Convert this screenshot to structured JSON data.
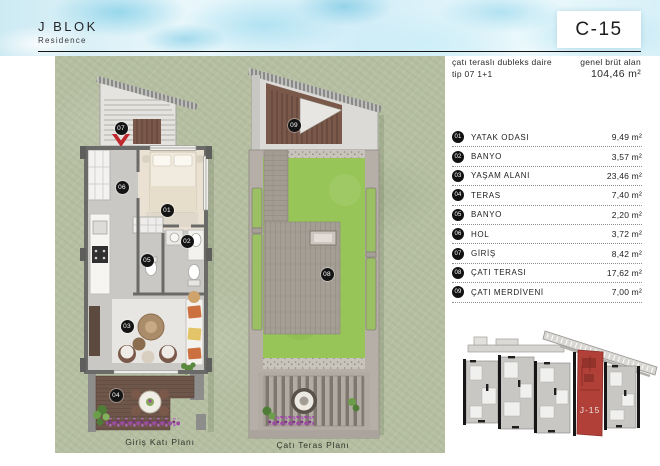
{
  "header": {
    "project": "J BLOK",
    "project_sub": "Residence",
    "unit_code": "C-15"
  },
  "unit_info": {
    "type_label": "çatı teraslı dubleks daire",
    "type_code": "tip 07 1+1",
    "area_label": "genel brüt alan",
    "area_value": "104,46 m²"
  },
  "plans": {
    "ground": {
      "caption": "Giriş Katı Planı"
    },
    "roof": {
      "caption": "Çatı Teras Planı"
    }
  },
  "rooms": [
    {
      "no": "01",
      "label": "YATAK ODASI",
      "area": "9,49 m²"
    },
    {
      "no": "02",
      "label": "BANYO",
      "area": "3,57 m²"
    },
    {
      "no": "03",
      "label": "YAŞAM ALANI",
      "area": "23,46 m²"
    },
    {
      "no": "04",
      "label": "TERAS",
      "area": "7,40 m²"
    },
    {
      "no": "05",
      "label": "BANYO",
      "area": "2,20 m²"
    },
    {
      "no": "06",
      "label": "HOL",
      "area": "3,72 m²"
    },
    {
      "no": "07",
      "label": "GİRİŞ",
      "area": "8,42 m²"
    },
    {
      "no": "08",
      "label": "ÇATI TERASI",
      "area": "17,62 m²"
    },
    {
      "no": "09",
      "label": "ÇATI MERDİVENİ",
      "area": "7,00 m²"
    }
  ],
  "site_plan": {
    "highlight_label": "J-15"
  },
  "colors": {
    "accent_red": "#b04038",
    "entry_arrow_red": "#c0272d",
    "grass_bg": "#b6bfa2",
    "roof_green": "#97c558",
    "deck_brown": "#6f564a",
    "pavement": "#b5afa7",
    "watercolor_blue": "#a9ddf0",
    "badge_black": "#141414"
  }
}
